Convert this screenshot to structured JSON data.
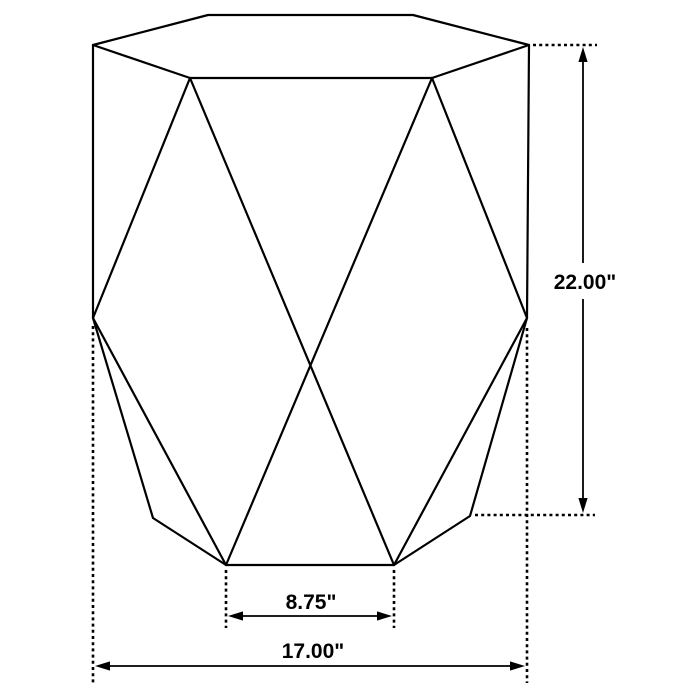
{
  "page": {
    "background_color": "#ffffff",
    "line_color": "#000000"
  },
  "diagram": {
    "subject": "geometric-hexagonal-drum-accent-table",
    "view": "perspective-line-drawing-with-dimensions",
    "dimensions": {
      "height": {
        "label": "22.00\"",
        "value": 22.0,
        "unit": "inches",
        "orientation": "vertical",
        "measures": "overall height from base bottom-right vertex to table top"
      },
      "base_front_edge": {
        "label": "8.75\"",
        "value": 8.75,
        "unit": "inches",
        "orientation": "horizontal",
        "measures": "width of bottom front edge"
      },
      "overall_width": {
        "label": "17.00\"",
        "value": 17.0,
        "unit": "inches",
        "orientation": "horizontal",
        "measures": "overall width at widest (waist) points"
      }
    }
  }
}
